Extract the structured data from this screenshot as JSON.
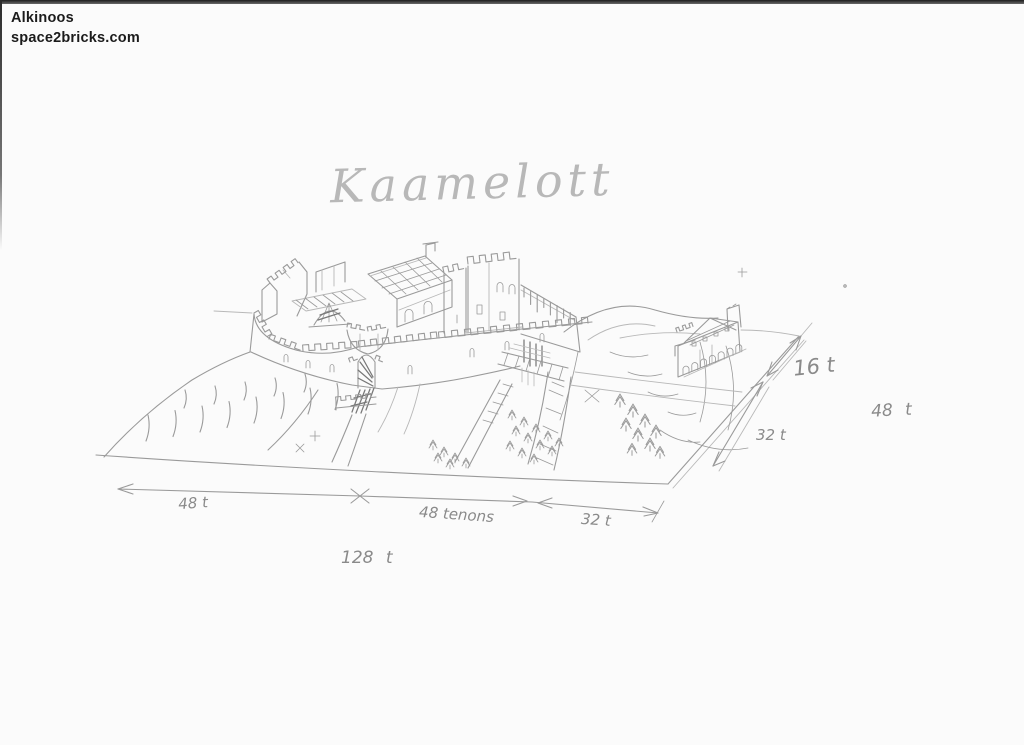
{
  "colors": {
    "paper": "#fbfbfb",
    "pencil": "#9a9a9a",
    "pencil_light": "#b8b8b8",
    "pencil_dark": "#787878",
    "scan_edge": "#2b2b2b",
    "watermark_text": "#1b1b1b"
  },
  "header": {
    "line1": "Alkinoos",
    "line2": "space2bricks.com"
  },
  "sketch": {
    "title": "Kaamelott"
  },
  "dimensions": {
    "bottom_left": "48 t",
    "bottom_middle": "48 tenons",
    "bottom_right": "32 t",
    "bottom_total": "128 t",
    "right_front": "32 t",
    "right_back": "16 t",
    "right_total": "48 t"
  }
}
